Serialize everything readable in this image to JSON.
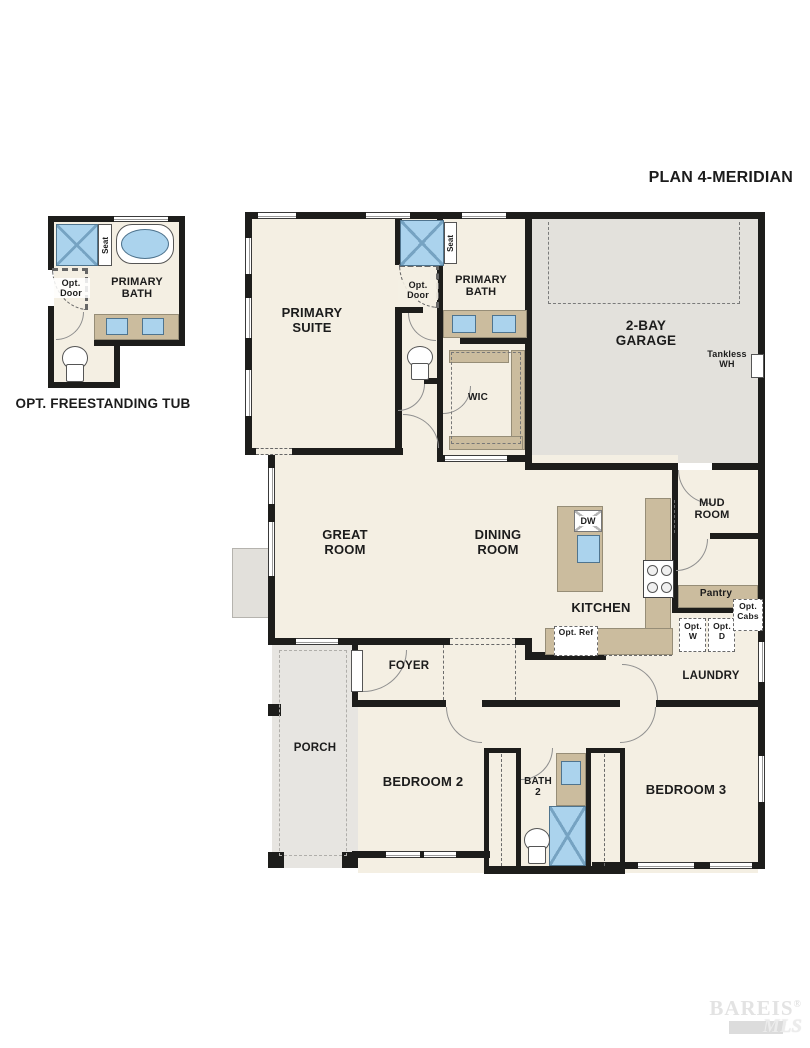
{
  "plan_title": "PLAN 4-MERIDIAN",
  "inset": {
    "caption": "OPT. FREESTANDING TUB",
    "room_label": "PRIMARY BATH",
    "seat_label": "Seat",
    "opt_door_label": "Opt. Door"
  },
  "rooms": {
    "primary_suite": "PRIMARY SUITE",
    "primary_bath": "PRIMARY BATH",
    "wic": "WIC",
    "garage": "2-BAY GARAGE",
    "mud_room": "MUD ROOM",
    "great_room": "GREAT ROOM",
    "dining_room": "DINING ROOM",
    "kitchen": "KITCHEN",
    "pantry": "Pantry",
    "laundry": "LAUNDRY",
    "foyer": "FOYER",
    "porch": "PORCH",
    "bedroom_2": "BEDROOM 2",
    "bath_2": "BATH 2",
    "bedroom_3": "BEDROOM 3"
  },
  "fixtures": {
    "seat_label": "Seat",
    "opt_door_label": "Opt. Door",
    "dishwasher": "DW",
    "opt_ref": "Opt. Ref",
    "opt_washer": "Opt. W",
    "opt_dryer": "Opt. D",
    "opt_cabs": "Opt. Cabs",
    "tankless_wh": "Tankless WH"
  },
  "watermark": {
    "brand": "BAREIS",
    "registered": "®",
    "suffix": "MLS"
  },
  "colors": {
    "wall": "#1d1d1b",
    "floor": "#f4efe3",
    "garage_floor": "#e3e1dc",
    "porch_floor": "#e7e5e1",
    "counter": "#cbbc9e",
    "fixture_blue": "#abd3ed",
    "watermark": "#e2e2e2"
  }
}
